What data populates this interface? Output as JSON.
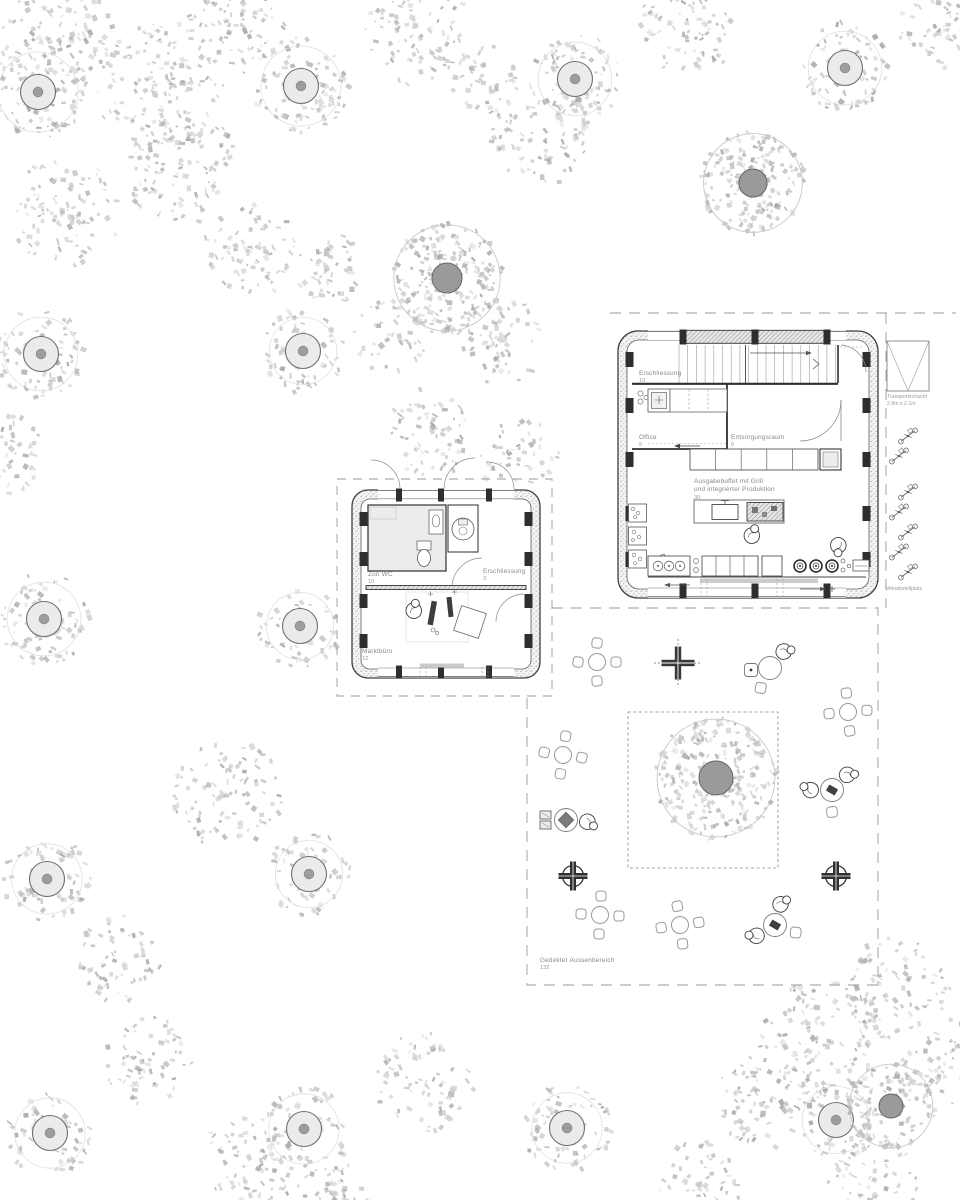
{
  "labels": {
    "hall_ersch": {
      "name": "Erschliessung",
      "num": "10"
    },
    "office": {
      "name": "Office",
      "num": "5"
    },
    "entsorgung": {
      "name": "Entsorgungsraum",
      "num": "6"
    },
    "buffet": {
      "l1": "Ausgabebuffet mit Grill",
      "l2": "und integrierter Produktion",
      "num": "30"
    },
    "schacht": {
      "name": "Transportschacht",
      "dim": "2.8m x 2.1m"
    },
    "velo": {
      "name": "Veloabstellplatz"
    },
    "wc": {
      "name": "Züri WC",
      "num": "10"
    },
    "pav_ersch": {
      "name": "Erschliessung",
      "num": "3"
    },
    "markt": {
      "name": "Marktbüro",
      "num": "12"
    },
    "aussen": {
      "name": "Gedekter Aussenbereich",
      "num": "132"
    }
  },
  "colors": {
    "line": "#3f3f3f",
    "light_line": "#8a8a8a",
    "dash": "#9a9a9a",
    "fleck_palette": [
      "#b3b3b3",
      "#c4c4c4",
      "#d3d3d3",
      "#a6a6a6"
    ],
    "trunk_solid": "#9a9a9a",
    "trunk_ring_fill": "#ebebeb"
  },
  "trees": {
    "small": [
      [
        38,
        92,
        50
      ],
      [
        301,
        86,
        50
      ],
      [
        575,
        79,
        46
      ],
      [
        845,
        68,
        46
      ],
      [
        41,
        354,
        46
      ],
      [
        303,
        351,
        42
      ],
      [
        44,
        619,
        46
      ],
      [
        300,
        626,
        42
      ],
      [
        47,
        879,
        44
      ],
      [
        309,
        874,
        42
      ],
      [
        50,
        1133,
        44
      ],
      [
        304,
        1129,
        44
      ],
      [
        567,
        1128,
        44
      ],
      [
        836,
        1120,
        42
      ]
    ],
    "large": [
      [
        447,
        278,
        56,
        15
      ],
      [
        753,
        183,
        52,
        14
      ],
      [
        716,
        778,
        62,
        17
      ],
      [
        891,
        1106,
        44,
        12
      ]
    ],
    "canopies": [
      [
        60,
        40,
        60
      ],
      [
        160,
        85,
        65
      ],
      [
        235,
        25,
        50
      ],
      [
        420,
        32,
        55
      ],
      [
        480,
        80,
        38
      ],
      [
        690,
        25,
        50
      ],
      [
        940,
        28,
        42
      ],
      [
        65,
        212,
        55
      ],
      [
        182,
        168,
        58
      ],
      [
        250,
        252,
        48
      ],
      [
        325,
        268,
        40
      ],
      [
        540,
        138,
        50
      ],
      [
        500,
        340,
        45
      ],
      [
        390,
        335,
        38
      ],
      [
        432,
        432,
        45
      ],
      [
        520,
        458,
        40
      ],
      [
        8,
        455,
        40
      ],
      [
        228,
        795,
        55
      ],
      [
        118,
        958,
        45
      ],
      [
        252,
        1160,
        50
      ],
      [
        150,
        1062,
        45
      ],
      [
        425,
        1082,
        50
      ],
      [
        335,
        1192,
        40
      ],
      [
        700,
        1186,
        45
      ],
      [
        820,
        1042,
        62
      ],
      [
        762,
        1102,
        48
      ],
      [
        898,
        988,
        52
      ],
      [
        946,
        1062,
        45
      ],
      [
        872,
        1182,
        45
      ]
    ]
  },
  "furniture": {
    "tables4": [
      [
        597,
        662,
        0
      ],
      [
        563,
        755,
        8
      ],
      [
        848,
        712,
        -5
      ],
      [
        600,
        915,
        3
      ],
      [
        680,
        925,
        -8
      ]
    ],
    "round_tables": [
      {
        "c": [
          770,
          668
        ],
        "people": [
          -50
        ],
        "chairs": [
          115
        ],
        "box": [
          751,
          670
        ],
        "item": false,
        "wrects": false
      },
      {
        "c": [
          832,
          790
        ],
        "people": [
          180,
          -45
        ],
        "chairs": [
          90
        ],
        "box": null,
        "item": true,
        "wrects": false
      },
      {
        "c": [
          775,
          925
        ],
        "people": [
          150,
          -75
        ],
        "chairs": [
          20
        ],
        "box": null,
        "item": true,
        "wrects": false
      },
      {
        "c": [
          566,
          820
        ],
        "people": [
          5
        ],
        "chairs": [],
        "box": null,
        "item": "diamond",
        "wrects": true
      }
    ],
    "crosses_plain": [
      [
        678,
        663
      ]
    ],
    "crosses_circled": [
      [
        573,
        876
      ],
      [
        836,
        876
      ]
    ],
    "bikes": [
      [
        908,
        436
      ],
      [
        899,
        456
      ],
      [
        908,
        492
      ],
      [
        899,
        512
      ],
      [
        908,
        532
      ],
      [
        899,
        552
      ],
      [
        908,
        572
      ]
    ],
    "loose_people": [
      {
        "p": [
          752,
          536
        ],
        "rot": -20
      },
      {
        "p": [
          838,
          545
        ],
        "rot": 140
      },
      {
        "p": [
          414,
          611
        ],
        "rot": -30
      }
    ]
  }
}
